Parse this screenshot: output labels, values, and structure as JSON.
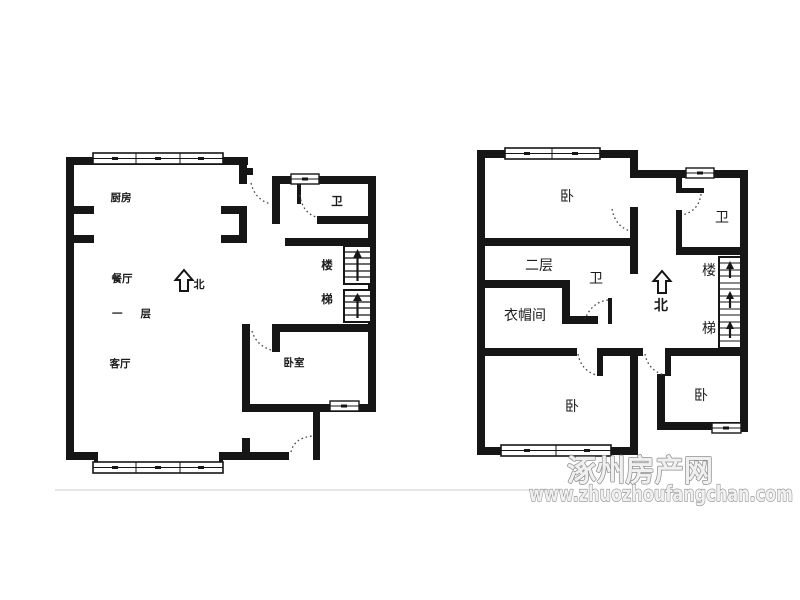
{
  "watermark": {
    "site_name": "涿州房产网",
    "site_url": "www.zhuozhoufangchan.com"
  },
  "first_floor": {
    "floor_label": "一层",
    "north_label": "北",
    "kitchen": "厨房",
    "dining_room": "餐厅",
    "living_room": "客厅",
    "bedroom": "卧室",
    "bathroom": "卫",
    "stairs_upper_char": "楼",
    "stairs_lower_char": "梯"
  },
  "second_floor": {
    "floor_label": "二层",
    "north_label": "北",
    "bedroom_top": "卧",
    "bathroom_top": "卫",
    "bathroom_middle": "卫",
    "cloakroom": "衣帽间",
    "bedroom_bottom_left": "卧",
    "bedroom_bottom_right": "卧",
    "stairs_upper_char": "楼",
    "stairs_lower_char": "梯"
  },
  "colors": {
    "wall": "#161616",
    "watermark_outline": "#8d8d8d",
    "watermark_fill": "#f0f0f0",
    "faint_line": "#e6e6e6"
  }
}
